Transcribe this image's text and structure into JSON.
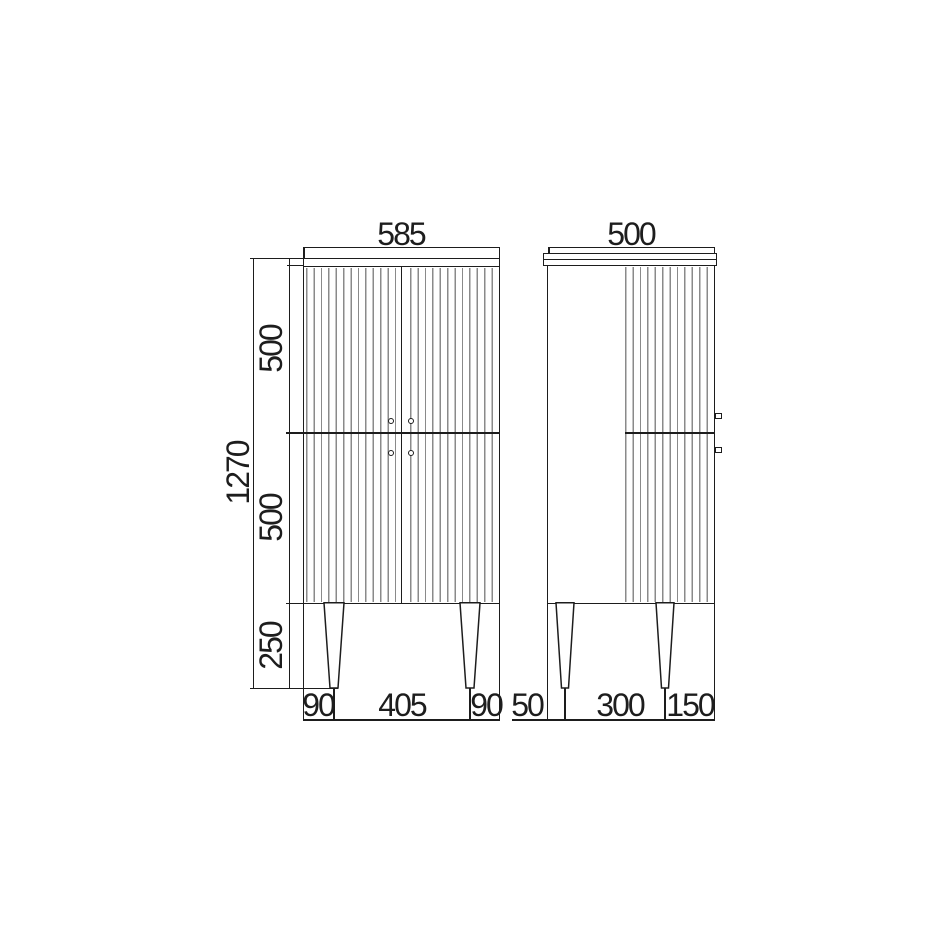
{
  "colors": {
    "line": "#1d1d1d",
    "flute": "#8a8a8a",
    "background": "#ffffff"
  },
  "front_view": {
    "width_dim": "585",
    "total_height_dim": "1270",
    "height_dims": [
      "500",
      "500",
      "250"
    ],
    "base_dims": [
      "90",
      "405",
      "90"
    ]
  },
  "side_view": {
    "depth_dim": "500",
    "base_dims": [
      "50",
      "300",
      "150"
    ]
  }
}
